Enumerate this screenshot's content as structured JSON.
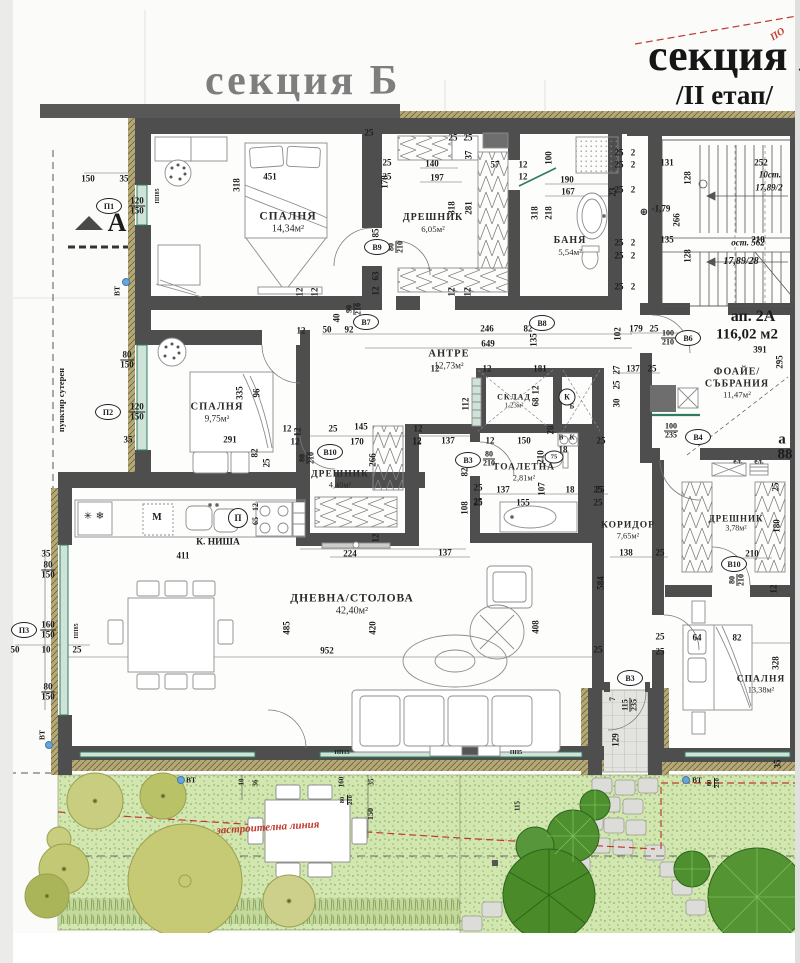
{
  "titles": {
    "section_b": "секция Б",
    "section_a": "секция А",
    "stage": "/II етап/",
    "red_note": "ПО"
  },
  "apartment": {
    "id": "ап. 2А",
    "area": "116,02 м2",
    "corner_a": "а",
    "corner_88": "88"
  },
  "stairs": {
    "up_steps": "10ст.",
    "up_rise": "17,89/2",
    "rest": "ост. 562",
    "rise2": "17,89/28",
    "level": "-1,79"
  },
  "rooms": [
    {
      "name": "СПАЛНЯ",
      "area": "14,34м²",
      "x": 288,
      "y": 223,
      "fs": 11.5
    },
    {
      "name": "ДРЕШНИК",
      "area": "6,05м²",
      "x": 433,
      "y": 223,
      "fs": 10
    },
    {
      "name": "БАНЯ",
      "area": "5,54м²",
      "x": 570,
      "y": 246,
      "fs": 10
    },
    {
      "name": "АНТРЕ",
      "area": "12,73м²",
      "x": 449,
      "y": 360,
      "fs": 10.5
    },
    {
      "name": "СПАЛНЯ",
      "area": "9,75м²",
      "x": 217,
      "y": 413,
      "fs": 10.5
    },
    {
      "name": "СКЛАД",
      "area": "1,23м²",
      "x": 514,
      "y": 401,
      "fs": 8
    },
    {
      "name": "ТОАЛЕТНА",
      "area": "2,81м²",
      "x": 524,
      "y": 473,
      "fs": 9.5
    },
    {
      "name": "ДРЕШНИК",
      "area": "4,40м²",
      "x": 340,
      "y": 480,
      "fs": 9.5
    },
    {
      "name": "КОРИДОР",
      "area": "7,65м²",
      "x": 628,
      "y": 531,
      "fs": 9.5
    },
    {
      "name": "ДРЕШНИК",
      "area": "3,78м²",
      "x": 736,
      "y": 523,
      "fs": 9
    },
    {
      "name": "ДНЕВНА/СТОЛОВА",
      "area": "42,40м²",
      "x": 352,
      "y": 605,
      "fs": 11.5
    },
    {
      "name": "СПАЛНЯ",
      "area": "13,38м²",
      "x": 761,
      "y": 685,
      "fs": 9.5
    },
    {
      "name": "ФОАЙЕ/СЪБРАНИЯ",
      "area": "11,47м²",
      "x": 737,
      "y": 383,
      "fs": 10
    }
  ],
  "markers": [
    {
      "t": "П1",
      "x": 109,
      "y": 206
    },
    {
      "t": "П2",
      "x": 108,
      "y": 412
    },
    {
      "t": "П3",
      "x": 24,
      "y": 630
    },
    {
      "t": "В9",
      "x": 377,
      "y": 247
    },
    {
      "t": "В7",
      "x": 366,
      "y": 322
    },
    {
      "t": "В8",
      "x": 542,
      "y": 323
    },
    {
      "t": "В10",
      "x": 330,
      "y": 452
    },
    {
      "t": "В3",
      "x": 468,
      "y": 460
    },
    {
      "t": "В6",
      "x": 688,
      "y": 338
    },
    {
      "t": "В4",
      "x": 698,
      "y": 437
    },
    {
      "t": "В10",
      "x": 734,
      "y": 564
    },
    {
      "t": "В3",
      "x": 630,
      "y": 678
    },
    {
      "t": "75",
      "x": 554,
      "y": 457,
      "w": 17,
      "h": 11,
      "fs": 6.5
    },
    {
      "t": "К",
      "x": 567,
      "y": 397,
      "w": 15,
      "h": 15,
      "fs": 8
    },
    {
      "t": "П",
      "x": 238,
      "y": 518,
      "w": 18,
      "h": 18,
      "fs": 9
    }
  ],
  "dots": [
    {
      "x": 126,
      "y": 282
    },
    {
      "x": 49,
      "y": 745
    },
    {
      "x": 181,
      "y": 780
    },
    {
      "x": 686,
      "y": 780
    }
  ],
  "labels": [
    {
      "t": "150",
      "x": 88,
      "y": 179
    },
    {
      "t": "35",
      "x": 124,
      "y": 179
    },
    {
      "t": "120/150",
      "x": 137,
      "y": 206,
      "f": 1
    },
    {
      "t": "80/150",
      "x": 127,
      "y": 360,
      "f": 1
    },
    {
      "t": "120/150",
      "x": 137,
      "y": 412,
      "f": 1
    },
    {
      "t": "35",
      "x": 128,
      "y": 440
    },
    {
      "n": "section-mark-a",
      "t": "A",
      "x": 117,
      "y": 223,
      "fs": 26
    },
    {
      "n": "note-dashed",
      "t": "пунктир сутерен",
      "x": 61,
      "y": 400,
      "r": -90,
      "fs": 8.5
    },
    {
      "t": "35",
      "x": 46,
      "y": 554
    },
    {
      "t": "80/150",
      "x": 48,
      "y": 570,
      "f": 1
    },
    {
      "t": "160/150",
      "x": 48,
      "y": 630,
      "f": 1
    },
    {
      "t": "50",
      "x": 15,
      "y": 650
    },
    {
      "t": "10",
      "x": 46,
      "y": 650
    },
    {
      "t": "25",
      "x": 77,
      "y": 650
    },
    {
      "t": "80/150",
      "x": 48,
      "y": 692,
      "f": 1
    },
    {
      "t": "ВТ",
      "x": 117,
      "y": 291,
      "r": -90,
      "fs": 7.5
    },
    {
      "t": "ВТ",
      "x": 42,
      "y": 735,
      "r": -90,
      "fs": 7.5
    },
    {
      "t": "ВТ",
      "x": 191,
      "y": 780,
      "fs": 7.5
    },
    {
      "t": "ВТ",
      "x": 697,
      "y": 780,
      "fs": 7.5
    },
    {
      "t": "451",
      "x": 270,
      "y": 177
    },
    {
      "t": "318",
      "x": 237,
      "y": 185,
      "r": -90
    },
    {
      "t": "170",
      "x": 385,
      "y": 182,
      "r": -90
    },
    {
      "t": "25",
      "x": 369,
      "y": 133
    },
    {
      "t": "25",
      "x": 387,
      "y": 163
    },
    {
      "t": "25",
      "x": 387,
      "y": 177
    },
    {
      "t": "85",
      "x": 376,
      "y": 233,
      "r": -90
    },
    {
      "t": "80/210",
      "x": 396,
      "y": 247,
      "f": 1,
      "r": -90,
      "fs": 8
    },
    {
      "t": "63",
      "x": 376,
      "y": 276,
      "r": -90
    },
    {
      "t": "12",
      "x": 376,
      "y": 291,
      "r": -90
    },
    {
      "t": "12",
      "x": 300,
      "y": 292,
      "r": -90
    },
    {
      "t": "12",
      "x": 315,
      "y": 292,
      "r": -90
    },
    {
      "t": "40",
      "x": 337,
      "y": 318,
      "r": -90
    },
    {
      "t": "12",
      "x": 301,
      "y": 331
    },
    {
      "t": "50",
      "x": 327,
      "y": 330
    },
    {
      "t": "92",
      "x": 349,
      "y": 330
    },
    {
      "t": "90/210",
      "x": 354,
      "y": 309,
      "f": 1,
      "r": -90,
      "fs": 8
    },
    {
      "t": "ПП85",
      "x": 158,
      "y": 196,
      "r": -90,
      "fs": 6
    },
    {
      "t": "140",
      "x": 432,
      "y": 164
    },
    {
      "t": "197",
      "x": 437,
      "y": 178
    },
    {
      "t": "57",
      "x": 495,
      "y": 165
    },
    {
      "t": "37",
      "x": 469,
      "y": 155,
      "r": -90
    },
    {
      "t": "25",
      "x": 453,
      "y": 138
    },
    {
      "t": "25",
      "x": 468,
      "y": 138
    },
    {
      "t": "318",
      "x": 452,
      "y": 208,
      "r": -90
    },
    {
      "t": "281",
      "x": 469,
      "y": 208,
      "r": -90
    },
    {
      "t": "12",
      "x": 452,
      "y": 292,
      "r": -90
    },
    {
      "t": "12",
      "x": 468,
      "y": 292,
      "r": -90
    },
    {
      "t": "190",
      "x": 567,
      "y": 180
    },
    {
      "t": "167",
      "x": 568,
      "y": 192
    },
    {
      "t": "23",
      "x": 613,
      "y": 192,
      "r": -90
    },
    {
      "t": "100",
      "x": 549,
      "y": 158,
      "r": -90
    },
    {
      "t": "12",
      "x": 523,
      "y": 165
    },
    {
      "t": "12",
      "x": 523,
      "y": 177
    },
    {
      "t": "318",
      "x": 535,
      "y": 213,
      "r": -90
    },
    {
      "t": "218",
      "x": 549,
      "y": 213,
      "r": -90
    },
    {
      "t": "25",
      "x": 619,
      "y": 153
    },
    {
      "t": "2",
      "x": 633,
      "y": 153
    },
    {
      "t": "25",
      "x": 619,
      "y": 165
    },
    {
      "t": "2",
      "x": 633,
      "y": 165
    },
    {
      "t": "25",
      "x": 619,
      "y": 190
    },
    {
      "t": "2",
      "x": 633,
      "y": 190
    },
    {
      "t": "25",
      "x": 619,
      "y": 243
    },
    {
      "t": "2",
      "x": 633,
      "y": 243
    },
    {
      "t": "25",
      "x": 619,
      "y": 256
    },
    {
      "t": "2",
      "x": 633,
      "y": 256
    },
    {
      "t": "25",
      "x": 619,
      "y": 287
    },
    {
      "t": "2",
      "x": 633,
      "y": 287
    },
    {
      "t": "131",
      "x": 667,
      "y": 163
    },
    {
      "t": "252",
      "x": 761,
      "y": 163
    },
    {
      "t": "128",
      "x": 688,
      "y": 178,
      "r": -90
    },
    {
      "t": "266",
      "x": 677,
      "y": 220,
      "r": -90
    },
    {
      "t": "135",
      "x": 667,
      "y": 240
    },
    {
      "t": "210",
      "x": 758,
      "y": 240
    },
    {
      "t": "128",
      "x": 688,
      "y": 256,
      "r": -90
    },
    {
      "n": "stairs-note",
      "t": "10ст.",
      "x": 770,
      "y": 175,
      "i": 1
    },
    {
      "n": "stairs-note",
      "t": "17,89/2",
      "x": 769,
      "y": 188,
      "i": 1
    },
    {
      "n": "stairs-note",
      "t": "ост. 562",
      "x": 748,
      "y": 243,
      "i": 1
    },
    {
      "n": "stairs-note",
      "t": "17,89/28",
      "x": 741,
      "y": 262,
      "i": 1,
      "fs": 10
    },
    {
      "n": "level-mark",
      "t": "-1,79",
      "x": 661,
      "y": 209
    },
    {
      "n": "level-icon",
      "t": "⊕",
      "x": 644,
      "y": 213,
      "fs": 10,
      "sf": 1
    },
    {
      "n": "apartment-id",
      "t": "ап. 2А",
      "x": 753,
      "y": 317,
      "fs": 16
    },
    {
      "n": "apartment-area",
      "t": "116,02 м2",
      "x": 747,
      "y": 335,
      "fs": 15
    },
    {
      "t": "391",
      "x": 760,
      "y": 350
    },
    {
      "t": "295",
      "x": 780,
      "y": 362,
      "r": -90
    },
    {
      "t": "179",
      "x": 636,
      "y": 329
    },
    {
      "t": "25",
      "x": 654,
      "y": 329
    },
    {
      "t": "100/210",
      "x": 668,
      "y": 338,
      "f": 1,
      "fs": 8
    },
    {
      "t": "102",
      "x": 618,
      "y": 334,
      "r": -90
    },
    {
      "t": "137",
      "x": 633,
      "y": 369
    },
    {
      "t": "25",
      "x": 652,
      "y": 369
    },
    {
      "t": "27",
      "x": 617,
      "y": 370,
      "r": -90
    },
    {
      "t": "25",
      "x": 617,
      "y": 385,
      "r": -90
    },
    {
      "t": "30",
      "x": 617,
      "y": 403,
      "r": -90
    },
    {
      "t": "100/235",
      "x": 671,
      "y": 431,
      "f": 1,
      "fs": 8
    },
    {
      "n": "corner-a",
      "t": "а",
      "x": 782,
      "y": 440,
      "fs": 15
    },
    {
      "n": "corner-88",
      "t": "88",
      "x": 785,
      "y": 455,
      "fs": 15
    },
    {
      "t": "ел.",
      "x": 738,
      "y": 461,
      "fs": 7.5
    },
    {
      "t": "ел.",
      "x": 759,
      "y": 461,
      "fs": 7.5
    },
    {
      "t": "246",
      "x": 487,
      "y": 329
    },
    {
      "t": "82",
      "x": 528,
      "y": 329
    },
    {
      "t": "649",
      "x": 488,
      "y": 344
    },
    {
      "t": "135",
      "x": 534,
      "y": 340,
      "r": -90
    },
    {
      "t": "181",
      "x": 540,
      "y": 369
    },
    {
      "t": "12",
      "x": 487,
      "y": 369
    },
    {
      "t": "12",
      "x": 435,
      "y": 369
    },
    {
      "t": "112",
      "x": 466,
      "y": 404,
      "r": -90
    },
    {
      "t": "68",
      "x": 536,
      "y": 402,
      "r": -90
    },
    {
      "t": "12",
      "x": 536,
      "y": 390,
      "r": -90
    },
    {
      "t": "12",
      "x": 417,
      "y": 441
    },
    {
      "t": "137",
      "x": 448,
      "y": 441
    },
    {
      "t": "12",
      "x": 490,
      "y": 441
    },
    {
      "t": "150",
      "x": 524,
      "y": 441
    },
    {
      "t": "28",
      "x": 551,
      "y": 430,
      "r": -90
    },
    {
      "t": "18",
      "x": 563,
      "y": 450
    },
    {
      "t": "210",
      "x": 541,
      "y": 457,
      "r": -90
    },
    {
      "t": "107",
      "x": 542,
      "y": 489,
      "r": -90
    },
    {
      "t": "137",
      "x": 503,
      "y": 490
    },
    {
      "t": "18",
      "x": 570,
      "y": 490
    },
    {
      "t": "25",
      "x": 600,
      "y": 490
    },
    {
      "t": "155",
      "x": 523,
      "y": 503
    },
    {
      "t": "25",
      "x": 478,
      "y": 502
    },
    {
      "t": "108",
      "x": 465,
      "y": 508,
      "r": -90
    },
    {
      "t": "82",
      "x": 465,
      "y": 472,
      "r": -90
    },
    {
      "t": "80/210",
      "x": 489,
      "y": 459,
      "f": 1,
      "fs": 8
    },
    {
      "t": "В",
      "x": 561,
      "y": 438,
      "fs": 7
    },
    {
      "t": "К",
      "x": 572,
      "y": 438,
      "fs": 7
    },
    {
      "t": "Б",
      "x": 572,
      "y": 407,
      "fs": 7
    },
    {
      "t": "12",
      "x": 287,
      "y": 429
    },
    {
      "t": "25",
      "x": 333,
      "y": 429
    },
    {
      "t": "145",
      "x": 361,
      "y": 427
    },
    {
      "t": "12",
      "x": 418,
      "y": 429
    },
    {
      "t": "12",
      "x": 295,
      "y": 442
    },
    {
      "t": "170",
      "x": 357,
      "y": 442
    },
    {
      "t": "12",
      "x": 417,
      "y": 442
    },
    {
      "t": "266",
      "x": 373,
      "y": 460,
      "r": -90
    },
    {
      "t": "80/210",
      "x": 307,
      "y": 458,
      "f": 1,
      "r": -90,
      "fs": 8
    },
    {
      "t": "12",
      "x": 376,
      "y": 538,
      "r": -90
    },
    {
      "t": "224",
      "x": 350,
      "y": 554
    },
    {
      "t": "137",
      "x": 445,
      "y": 553
    },
    {
      "t": "25",
      "x": 478,
      "y": 488
    },
    {
      "t": "25",
      "x": 478,
      "y": 503
    },
    {
      "t": "335",
      "x": 240,
      "y": 393,
      "r": -90
    },
    {
      "t": "96",
      "x": 257,
      "y": 393,
      "r": -90
    },
    {
      "t": "291",
      "x": 230,
      "y": 440
    },
    {
      "t": "82",
      "x": 255,
      "y": 453,
      "r": -90
    },
    {
      "t": "25",
      "x": 267,
      "y": 463,
      "r": -90
    },
    {
      "t": "12",
      "x": 298,
      "y": 432,
      "r": -90
    },
    {
      "t": "ПП85",
      "x": 77,
      "y": 631,
      "r": -90,
      "fs": 6
    },
    {
      "t": "М",
      "x": 157,
      "y": 518,
      "fs": 10
    },
    {
      "n": "kitchen-niche",
      "t": "К. НИША",
      "x": 218,
      "y": 543,
      "fs": 9.5
    },
    {
      "t": "411",
      "x": 183,
      "y": 556
    },
    {
      "t": "65",
      "x": 256,
      "y": 521,
      "r": -90,
      "fs": 8
    },
    {
      "t": "12",
      "x": 256,
      "y": 507,
      "r": -90,
      "fs": 8
    },
    {
      "n": "fridge-icon",
      "t": "✳",
      "x": 88,
      "y": 517,
      "fs": 10,
      "sf": 1
    },
    {
      "n": "fridge-icon",
      "t": "❄",
      "x": 100,
      "y": 517,
      "fs": 10,
      "sf": 1
    },
    {
      "t": "952",
      "x": 327,
      "y": 651
    },
    {
      "t": "420",
      "x": 373,
      "y": 628,
      "r": -90
    },
    {
      "t": "485",
      "x": 287,
      "y": 628,
      "r": -90
    },
    {
      "t": "408",
      "x": 536,
      "y": 627,
      "r": -90
    },
    {
      "t": "ПП15",
      "x": 342,
      "y": 753,
      "fs": 6
    },
    {
      "t": "ПП5",
      "x": 516,
      "y": 753,
      "fs": 6
    },
    {
      "t": "25",
      "x": 601,
      "y": 441
    },
    {
      "t": "25",
      "x": 598,
      "y": 490
    },
    {
      "t": "25",
      "x": 598,
      "y": 503
    },
    {
      "t": "138",
      "x": 626,
      "y": 553
    },
    {
      "t": "25",
      "x": 660,
      "y": 553
    },
    {
      "t": "584",
      "x": 601,
      "y": 583,
      "r": -90
    },
    {
      "t": "210",
      "x": 752,
      "y": 554
    },
    {
      "t": "80/210",
      "x": 737,
      "y": 580,
      "f": 1,
      "r": -90,
      "fs": 8
    },
    {
      "t": "180",
      "x": 777,
      "y": 526,
      "r": -90
    },
    {
      "t": "25",
      "x": 776,
      "y": 487,
      "r": -90
    },
    {
      "t": "12",
      "x": 774,
      "y": 589,
      "r": -90
    },
    {
      "t": "64",
      "x": 697,
      "y": 638
    },
    {
      "t": "82",
      "x": 737,
      "y": 638
    },
    {
      "t": "328",
      "x": 776,
      "y": 663,
      "r": -90
    },
    {
      "t": "25",
      "x": 660,
      "y": 637
    },
    {
      "t": "25",
      "x": 660,
      "y": 652
    },
    {
      "t": "25",
      "x": 598,
      "y": 650
    },
    {
      "t": "115/235",
      "x": 630,
      "y": 705,
      "f": 1,
      "r": -90,
      "fs": 8
    },
    {
      "t": "7",
      "x": 613,
      "y": 699,
      "r": -90,
      "fs": 8
    },
    {
      "t": "129",
      "x": 616,
      "y": 740,
      "r": -90
    },
    {
      "t": "35",
      "x": 778,
      "y": 764,
      "r": -90
    },
    {
      "n": "building-line-label",
      "t": "застроителна линия",
      "x": 268,
      "y": 828,
      "r": -3.5,
      "c": "#c0392b",
      "fs": 11,
      "i": 1
    },
    {
      "t": "10",
      "x": 242,
      "y": 782,
      "r": -90,
      "fs": 7
    },
    {
      "t": "36",
      "x": 256,
      "y": 783,
      "r": -90,
      "fs": 7
    },
    {
      "t": "160",
      "x": 342,
      "y": 782,
      "r": -90,
      "fs": 7
    },
    {
      "t": "35",
      "x": 372,
      "y": 782,
      "r": -90,
      "fs": 7
    },
    {
      "t": "150",
      "x": 371,
      "y": 814,
      "r": -90,
      "fs": 8
    },
    {
      "t": "80/210",
      "x": 347,
      "y": 800,
      "f": 1,
      "r": -90,
      "fs": 6.5
    },
    {
      "t": "80/210",
      "x": 714,
      "y": 783,
      "f": 1,
      "r": -90,
      "fs": 6.5
    },
    {
      "t": "115",
      "x": 518,
      "y": 806,
      "r": -90,
      "fs": 7
    },
    {
      "n": "red-note",
      "t": "ПО",
      "x": 778,
      "y": 35,
      "r": -33,
      "c": "#c0392b",
      "fs": 10,
      "i": 1
    }
  ]
}
